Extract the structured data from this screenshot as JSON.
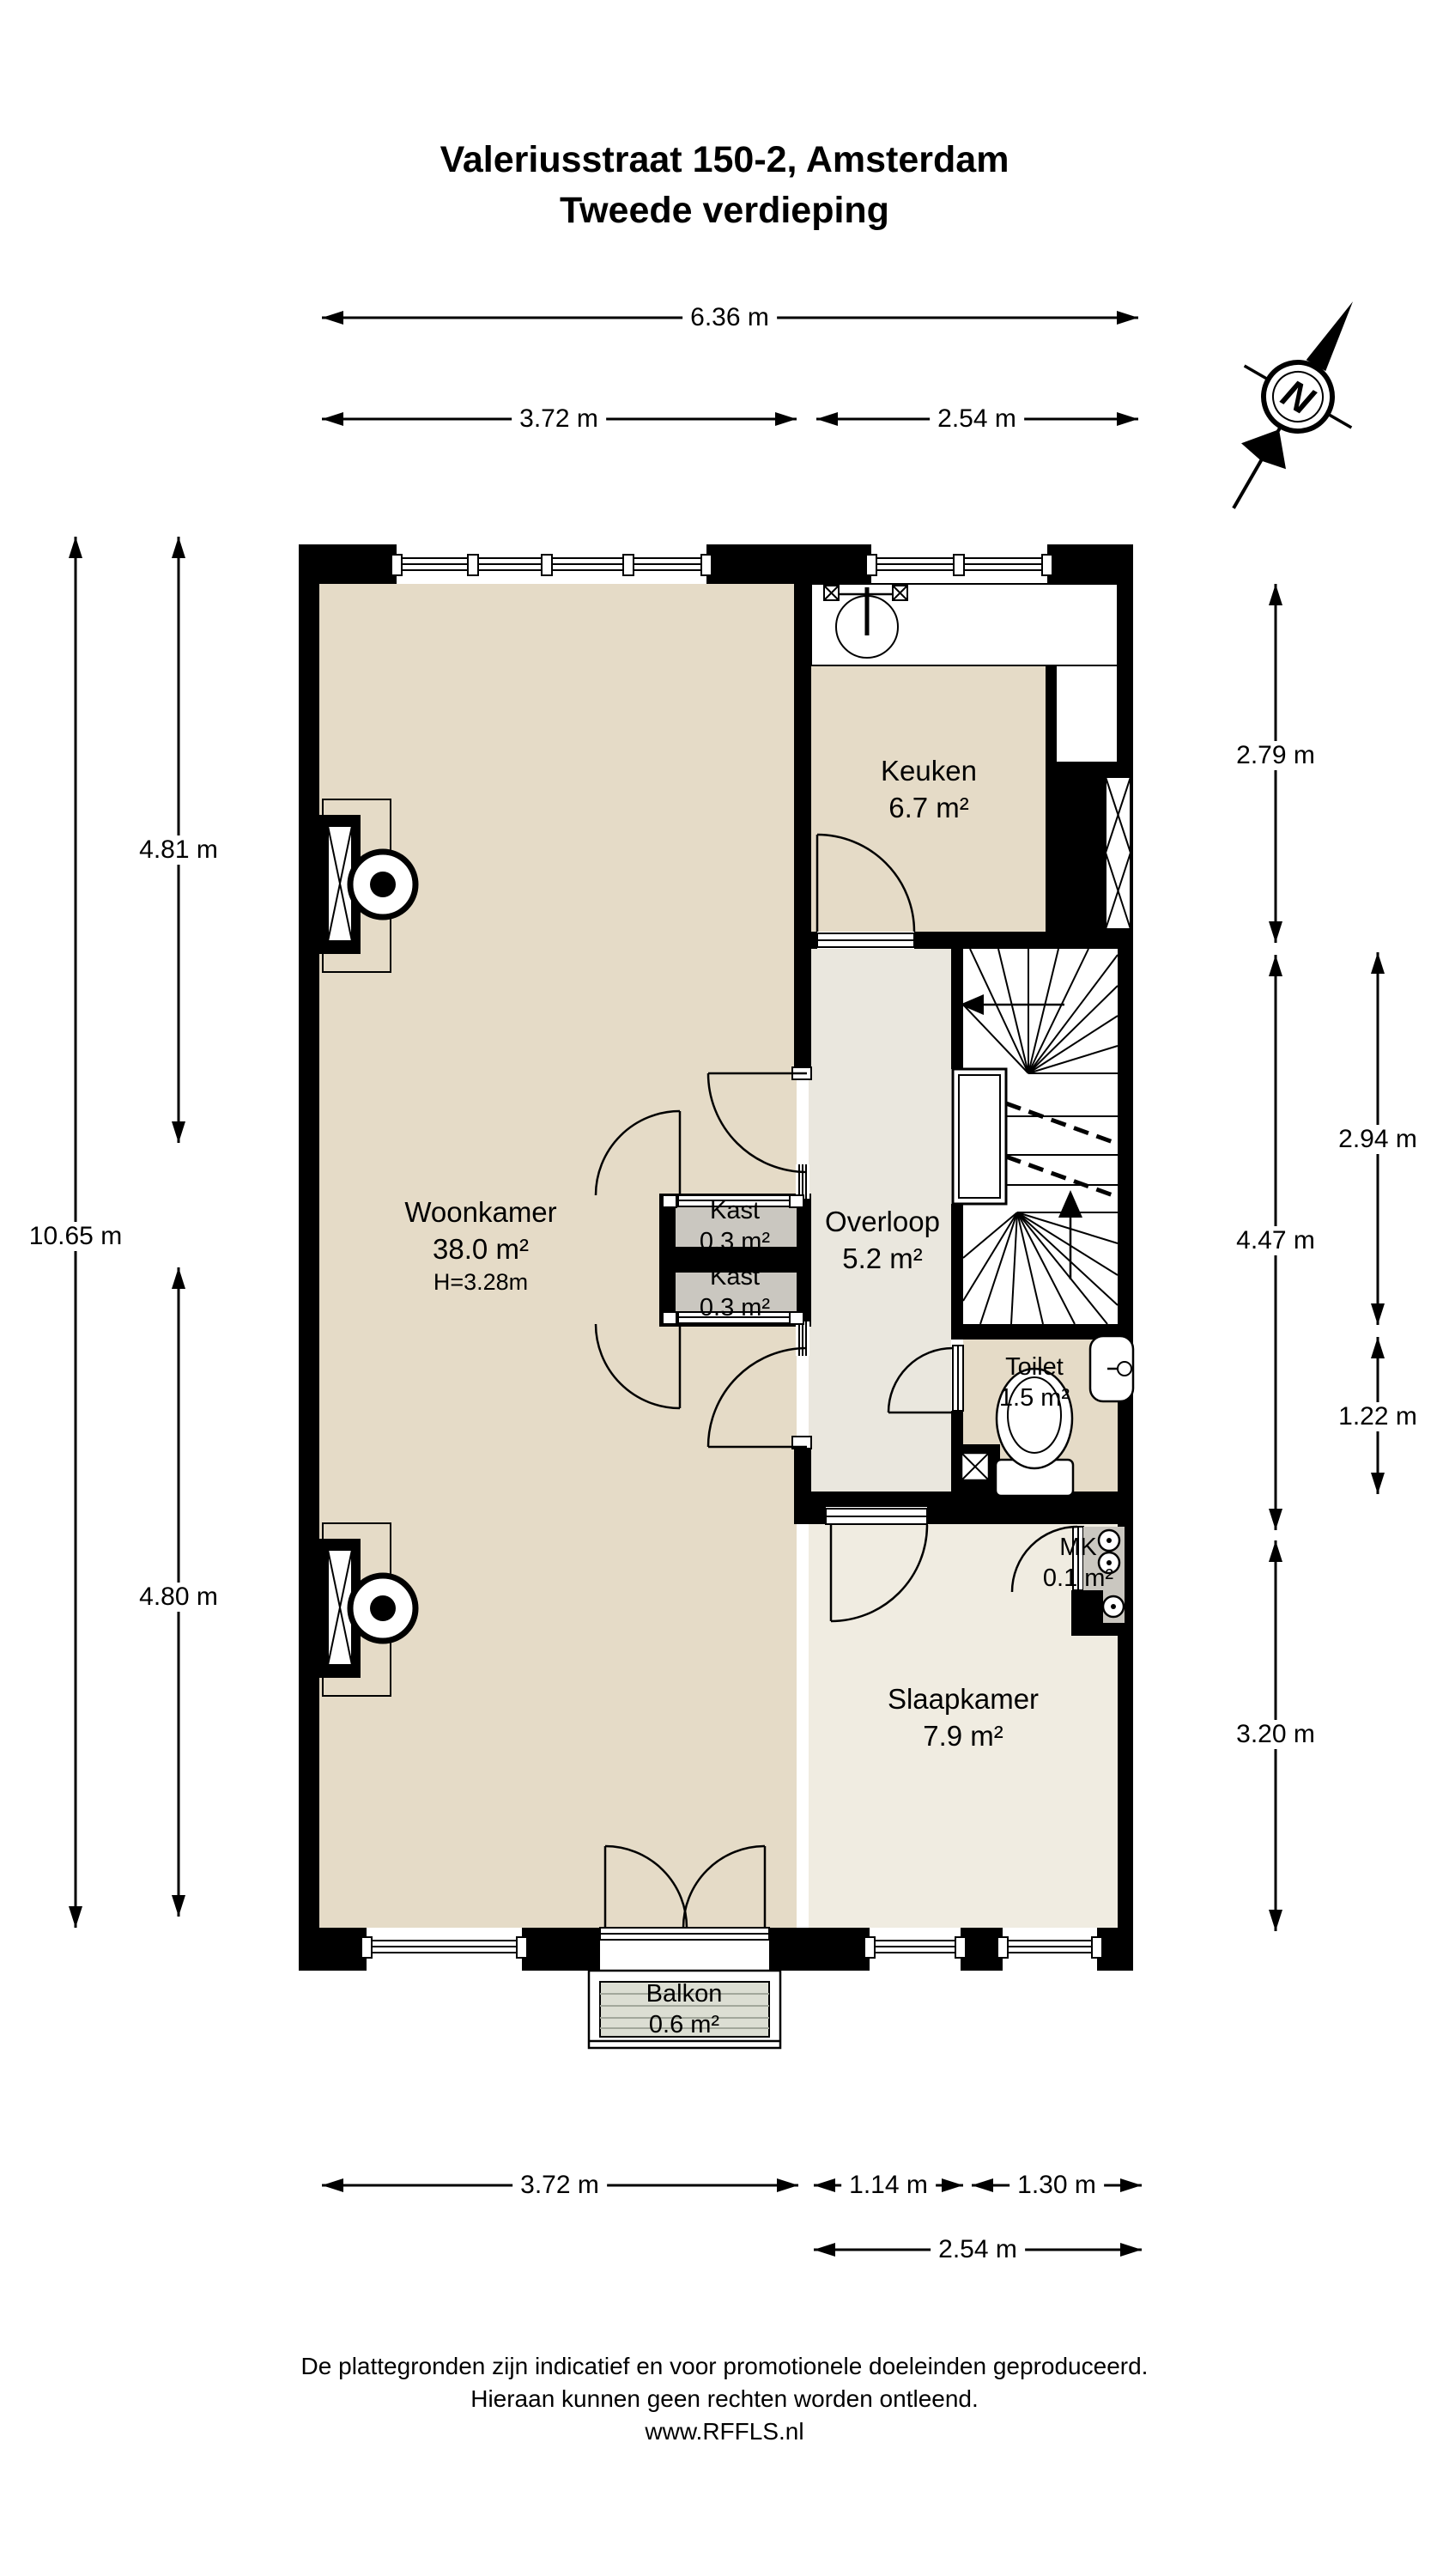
{
  "title": {
    "line1": "Valeriusstraat 150-2, Amsterdam",
    "line2": "Tweede verdieping"
  },
  "compass": {
    "letter": "N"
  },
  "rooms": {
    "woonkamer": {
      "name": "Woonkamer",
      "area": "38.0 m²",
      "ceiling_height": "H=3.28m"
    },
    "keuken": {
      "name": "Keuken",
      "area": "6.7 m²"
    },
    "overloop": {
      "name": "Overloop",
      "area": "5.2 m²"
    },
    "kast_boven": {
      "name": "Kast",
      "area": "0.3 m²"
    },
    "kast_onder": {
      "name": "Kast",
      "area": "0.3 m²"
    },
    "toilet": {
      "name": "Toilet",
      "area": "1.5 m²"
    },
    "mk": {
      "name": "MK",
      "area": "0.1 m²"
    },
    "slaapkamer": {
      "name": "Slaapkamer",
      "area": "7.9 m²"
    },
    "balkon": {
      "name": "Balkon",
      "area": "0.6 m²"
    }
  },
  "dimensions": {
    "top_total": "6.36 m",
    "top_left": "3.72 m",
    "top_right": "2.54 m",
    "left_total": "10.65 m",
    "left_upper": "4.81 m",
    "left_lower": "4.80 m",
    "right_keuken": "2.79 m",
    "right_middle": "4.47 m",
    "right_slaapkamer": "3.20 m",
    "right_inner_upper": "2.94 m",
    "right_inner_lower": "1.22 m",
    "bottom_left": "3.72 m",
    "bottom_middle": "1.14 m",
    "bottom_right": "1.30 m",
    "bottom_total": "2.54 m"
  },
  "footer": {
    "line1": "De plattegronden zijn indicatief en voor promotionele doeleinden geproduceerd.",
    "line2": "Hieraan kunnen geen rechten worden ontleend.",
    "line3": "www.RFFLS.nl"
  },
  "colors": {
    "wall": "#000000",
    "floor_main": "#e5dbc7",
    "floor_hall": "#eae7de",
    "floor_bedroom": "#f0ece1",
    "floor_closet": "#cac7c0",
    "floor_balcony": "#dcded3",
    "balcony_line": "#a2a79b"
  }
}
